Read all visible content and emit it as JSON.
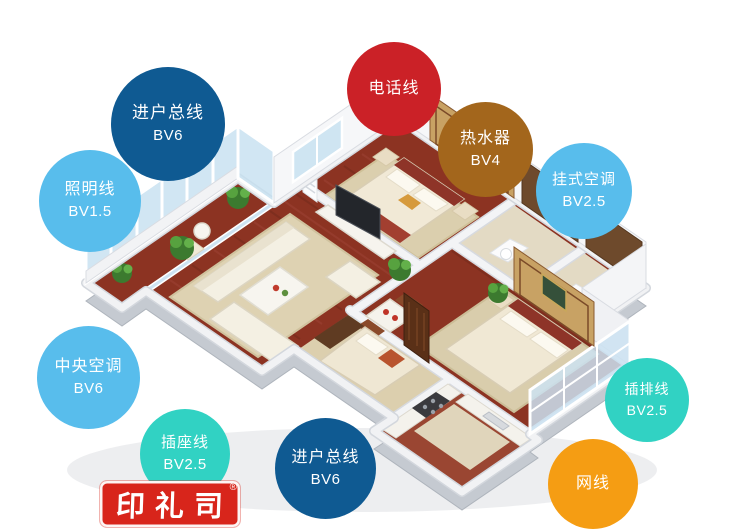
{
  "badges": [
    {
      "id": "entry-main-top",
      "label": "进户总线",
      "spec": "BV6",
      "color": "#0f5a92"
    },
    {
      "id": "lighting-wire",
      "label": "照明线",
      "spec": "BV1.5",
      "color": "#58bdec"
    },
    {
      "id": "telephone-wire",
      "label": "电话线",
      "spec": "",
      "color": "#cb2127"
    },
    {
      "id": "water-heater",
      "label": "热水器",
      "spec": "BV4",
      "color": "#a3661c"
    },
    {
      "id": "wall-mounted-ac",
      "label": "挂式空调",
      "spec": "BV2.5",
      "color": "#58bdec"
    },
    {
      "id": "central-ac",
      "label": "中央空调",
      "spec": "BV6",
      "color": "#58bdec"
    },
    {
      "id": "socket-wire",
      "label": "插座线",
      "spec": "BV2.5",
      "color": "#31d2c3"
    },
    {
      "id": "entry-main-bottom",
      "label": "进户总线",
      "spec": "BV6",
      "color": "#0f5a92"
    },
    {
      "id": "power-strip-wire",
      "label": "插排线",
      "spec": "BV2.5",
      "color": "#31d2c3"
    },
    {
      "id": "network-cable",
      "label": "网线",
      "spec": "",
      "color": "#f59d13"
    }
  ],
  "seal": {
    "text": "印礼司",
    "registered": "®",
    "color": "#d8251b"
  }
}
